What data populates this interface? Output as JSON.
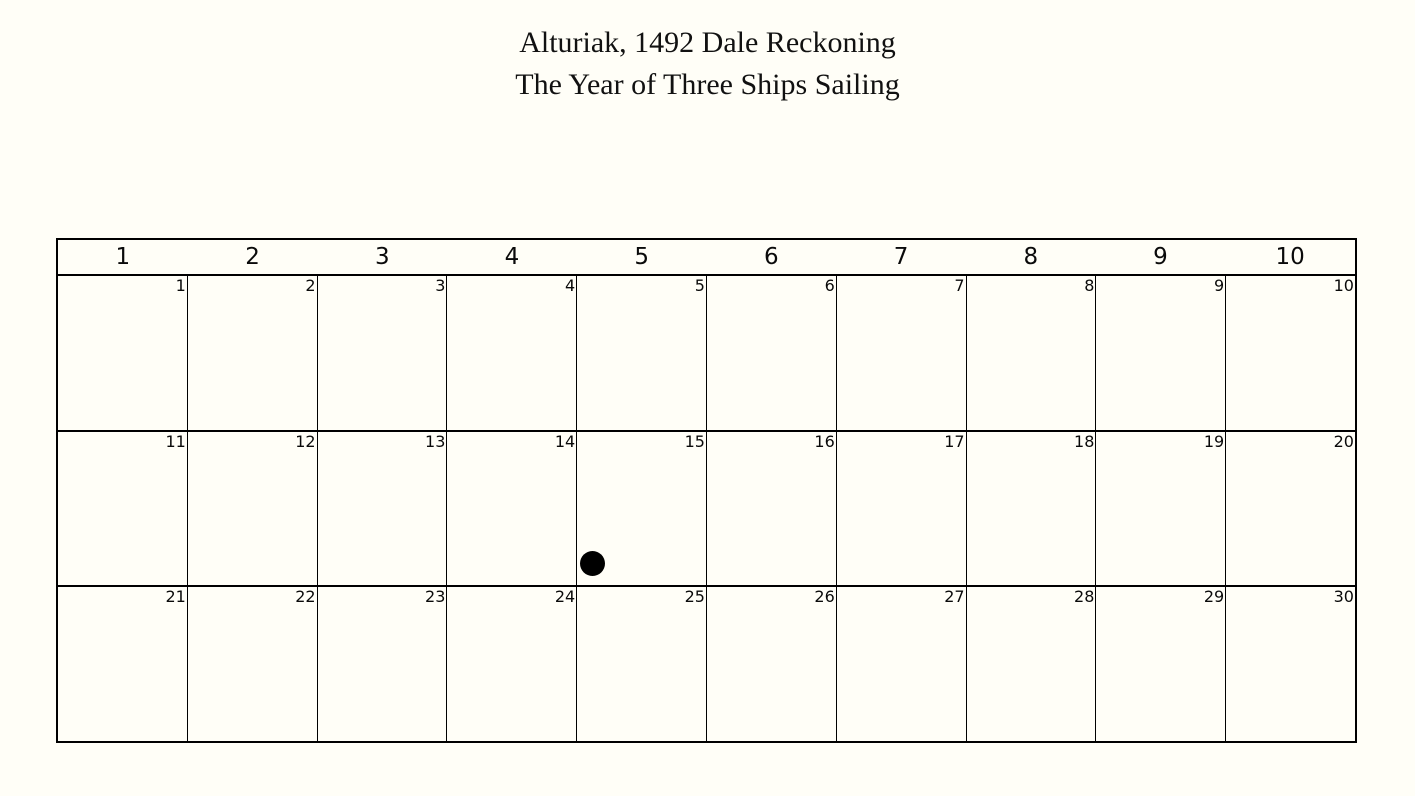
{
  "colors": {
    "background": "#FFFEF7",
    "grid_line": "#000000",
    "text": "#111111",
    "marker": "#000000"
  },
  "title": {
    "line1": "Alturiak, 1492 Dale Reckoning",
    "line2": "The Year of Three Ships Sailing"
  },
  "calendar": {
    "column_headers": [
      "1",
      "2",
      "3",
      "4",
      "5",
      "6",
      "7",
      "8",
      "9",
      "10"
    ],
    "days": [
      "1",
      "2",
      "3",
      "4",
      "5",
      "6",
      "7",
      "8",
      "9",
      "10",
      "11",
      "12",
      "13",
      "14",
      "15",
      "16",
      "17",
      "18",
      "19",
      "20",
      "21",
      "22",
      "23",
      "24",
      "25",
      "26",
      "27",
      "28",
      "29",
      "30"
    ],
    "marker": {
      "day": "15",
      "symbol": "filled-circle"
    }
  }
}
